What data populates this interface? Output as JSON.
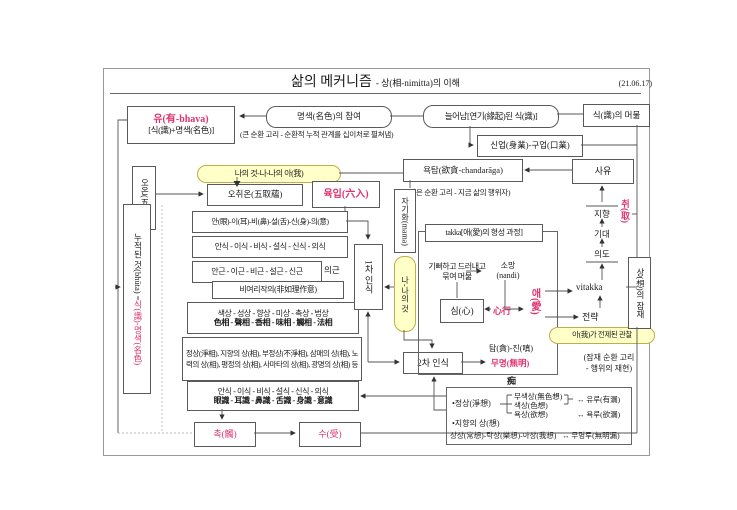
{
  "page": {
    "title_main": "삶의 메커니즘",
    "title_sub": "- 상(相-nimitta)의 이해",
    "date": "(21.06.17)"
  },
  "top": {
    "bhava_line1": "유(有-bhava)",
    "bhava_line2": "[식(識)+명색(名色)]",
    "namarupa_join": "명색(名色)의 참여",
    "big_loop_note": "(큰 순환 고리 - 순환적 누적 관계를 십이처로 펼쳐냄)",
    "arising": "늘어남[연기(緣起)된 식(識)]",
    "vinnana_stay": "식(識)의 머묾",
    "kamma": "신업(身業)-구업(口業)",
    "chandaraga": "욕탐(欲貪-chandarāga)",
    "small_loop_note": "(작은 순환 고리 - 지금 삶의 행위자)",
    "thinking": "사유"
  },
  "left": {
    "five_khandha": "오온(五蘊)",
    "mine_capsule": "나의 것-나-나의 아(我)",
    "five_upadana": "오취온(五取蘊)",
    "six_ayatana": "육입(六入)",
    "accumulated_prefix": "누적된 것(bhūta) = ",
    "accumulated_highlight": "식(識)-명색(名色)",
    "faculties": "안(眼)-이(耳)-비(鼻)-설(舌)-신(身)-의(意)",
    "consciousness_ko": "안식 - 이식 - 비식 - 설식 - 신식 - 의식",
    "roots": "안근 - 이근 - 비근 - 설근 - 신근",
    "mind_root": "의근",
    "ayoniso": "비여리작의(非如理作意)",
    "nimitta_ko": "색상 - 성상 - 향상 - 미상 - 촉상 - 법상",
    "nimitta_cn": "色相 - 聲相 - 香相 - 味相 - 觸相 - 法相",
    "nimitta_kinds": "정상(淨相), 지향의 상(相), 부정상(不淨相), 삼매의 상(相), 노력의 상(相), 평정의 상(相), 사마타의 상(相), 광명의 상(相) 등",
    "vinnana_ko": "안식 - 이식 - 비식 - 설식 - 신식 - 의식",
    "vinnana_cn": "眼識 - 耳識 - 鼻識 - 舌識 - 身識 - 意識",
    "phassa": "촉(觸)",
    "vedana": "수(受)"
  },
  "center": {
    "selfization": "자기화(mama)",
    "me_mine": "나-나의 것",
    "first_cognition": "1차 인식",
    "second_cognition": "2차 인식",
    "takka_title": "takka[애(愛)의 형성 과정]",
    "delight_line1": "기뻐하고 드러내고",
    "delight_line2": "묶여 머묾",
    "nandi_line1": "소망",
    "nandi_line2": "(nandi)",
    "citta": "심(心)",
    "citta_sankhara": "心行",
    "tanha": "애(愛)",
    "lobha_dosa": "탐(貪)-진(嗔)",
    "avijja": "무명(無明)",
    "moha": "痴"
  },
  "right": {
    "upadana": "취(取)",
    "direction": "지향",
    "expectation": "기대",
    "intention": "의도",
    "vitakka": "vitakka",
    "strategy": "전략",
    "self_observation": "아(我)가 전제된 관찰",
    "sanna_latency": "상(想)의 잠재",
    "latent_note_line1": "(잠재 순환 고리",
    "latent_note_line2": "- 행위의 재현)"
  },
  "sanna_box": {
    "pure": "•정상(淨想)",
    "formless": "무색상(無色想)",
    "form": "색상(色想)",
    "desire": "욕상(欲想)",
    "asava_being": "↔ 유루(有漏)",
    "asava_desire": "↔ 욕루(欲漏)",
    "directional": "•지향의 상(想)",
    "triple": "상상(常想)-락상(樂想)-아상(我想)",
    "asava_ignorance": "↔ 무명루(無明漏)"
  },
  "colors": {
    "accent": "#e0336e",
    "capsule_bg": "#ffffc8",
    "capsule_border": "#bfae4a"
  }
}
